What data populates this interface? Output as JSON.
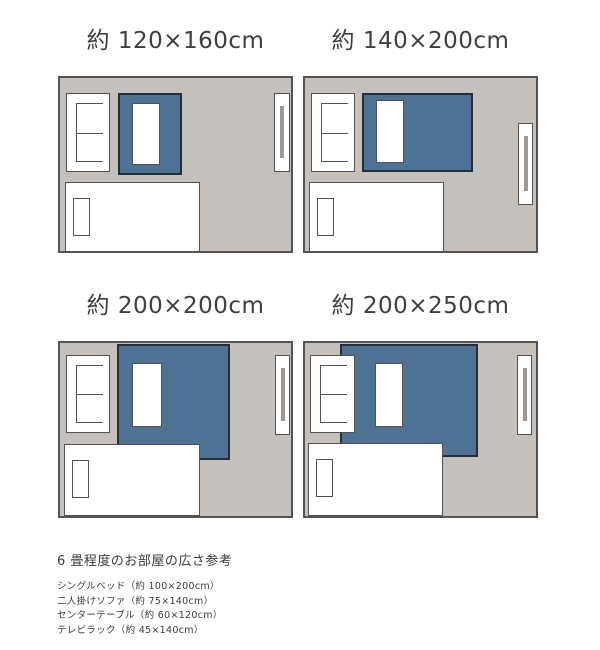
{
  "colors": {
    "page_bg": "#ffffff",
    "room_fill": "#c6c0bd",
    "room_border": "#56524f",
    "rug_fill": "#4d7294",
    "rug_border": "#252d35",
    "furniture_fill": "#ffffff",
    "furniture_border": "#55514e",
    "tv_bar": "#9b9896",
    "title_text": "#3f3f3f",
    "footer_text": "#3a3a3a"
  },
  "diagrams": [
    {
      "title": "約 120×160cm",
      "room": {
        "x": 58,
        "y": 76,
        "w": 235,
        "h": 177
      },
      "furniture": [
        {
          "type": "rug",
          "name": "rug-120x160",
          "x": 58,
          "y": 15,
          "w": 64,
          "h": 82
        },
        {
          "type": "sofa",
          "name": "two-seat-sofa",
          "x": 6,
          "y": 15,
          "w": 44,
          "h": 79
        },
        {
          "type": "table",
          "name": "center-table",
          "x": 72,
          "y": 25,
          "w": 28,
          "h": 62
        },
        {
          "type": "rack",
          "name": "tv-rack",
          "x": 214,
          "y": 15,
          "w": 16,
          "h": 79
        },
        {
          "type": "bed",
          "name": "single-bed",
          "x": 5,
          "y": 104,
          "w": 135,
          "h": 70
        }
      ]
    },
    {
      "title": "約 140×200cm",
      "room": {
        "x": 303,
        "y": 76,
        "w": 235,
        "h": 177
      },
      "furniture": [
        {
          "type": "rug",
          "name": "rug-140x200",
          "x": 57,
          "y": 15,
          "w": 111,
          "h": 79
        },
        {
          "type": "sofa",
          "name": "two-seat-sofa",
          "x": 6,
          "y": 15,
          "w": 44,
          "h": 79
        },
        {
          "type": "table",
          "name": "center-table",
          "x": 71,
          "y": 22,
          "w": 28,
          "h": 63
        },
        {
          "type": "rack",
          "name": "tv-rack",
          "x": 213,
          "y": 45,
          "w": 15,
          "h": 82
        },
        {
          "type": "bed",
          "name": "single-bed",
          "x": 4,
          "y": 104,
          "w": 135,
          "h": 70
        }
      ]
    },
    {
      "title": "約 200×200cm",
      "room": {
        "x": 58,
        "y": 341,
        "w": 235,
        "h": 177
      },
      "furniture": [
        {
          "type": "rug",
          "name": "rug-200x200",
          "x": 57,
          "y": 1,
          "w": 113,
          "h": 116
        },
        {
          "type": "sofa",
          "name": "two-seat-sofa",
          "x": 6,
          "y": 12,
          "w": 44,
          "h": 78
        },
        {
          "type": "table",
          "name": "center-table",
          "x": 72,
          "y": 20,
          "w": 30,
          "h": 64
        },
        {
          "type": "rack",
          "name": "tv-rack",
          "x": 215,
          "y": 12,
          "w": 15,
          "h": 80
        },
        {
          "type": "bed",
          "name": "single-bed",
          "x": 4,
          "y": 101,
          "w": 136,
          "h": 72
        }
      ]
    },
    {
      "title": "約 200×250cm",
      "room": {
        "x": 303,
        "y": 341,
        "w": 235,
        "h": 177
      },
      "furniture": [
        {
          "type": "rug",
          "name": "rug-200x250",
          "x": 35,
          "y": 1,
          "w": 138,
          "h": 113
        },
        {
          "type": "sofa",
          "name": "two-seat-sofa",
          "x": 5,
          "y": 12,
          "w": 45,
          "h": 78
        },
        {
          "type": "table",
          "name": "center-table",
          "x": 70,
          "y": 20,
          "w": 28,
          "h": 64
        },
        {
          "type": "rack",
          "name": "tv-rack",
          "x": 212,
          "y": 12,
          "w": 15,
          "h": 80
        },
        {
          "type": "bed",
          "name": "single-bed",
          "x": 3,
          "y": 100,
          "w": 135,
          "h": 73
        }
      ]
    }
  ],
  "footer": {
    "heading": "6 畳程度のお部屋の広さ参考",
    "items": [
      "シングルベッド（約 100×200cm）",
      "二人掛けソファ（約 75×140cm）",
      "センターテーブル（約 60×120cm）",
      "テレビラック（約 45×140cm）"
    ]
  }
}
